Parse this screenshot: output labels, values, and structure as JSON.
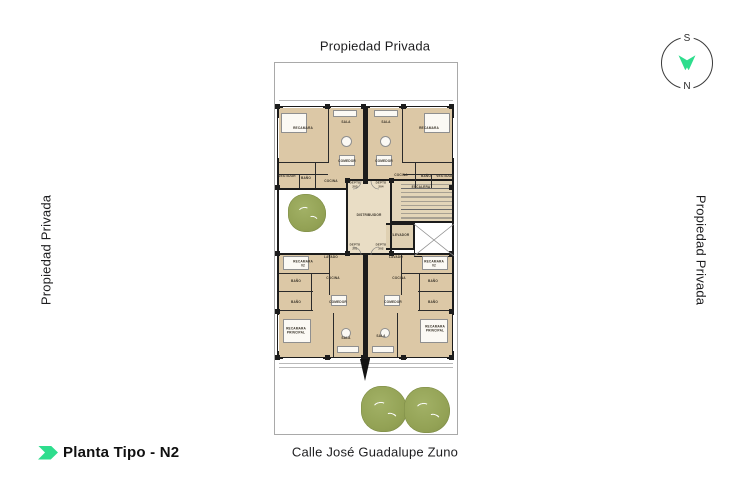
{
  "labels": {
    "top": "Propiedad Privada",
    "left": "Propiedad Privada",
    "right": "Propiedad Privada",
    "street": "Calle José Guadalupe Zuno",
    "title": "Planta Tipo - N2"
  },
  "compass": {
    "top": "S",
    "bottom": "N"
  },
  "colors": {
    "accent": "#2edd8d",
    "floor": "#dcc8a6",
    "floor_light": "#e9ddc5",
    "floor_stairs": "#e3d5b8",
    "floor_elevator": "#dfd0b2",
    "wall": "#1c1c1c",
    "partition": "#2a2a2a",
    "tree": "#93a255",
    "ledge": "#b9b9b9"
  },
  "plan": {
    "areas": [
      {
        "n": "ul-apartment",
        "x": 4,
        "y": 45,
        "w": 85,
        "h": 80,
        "c": "#dcc8a6"
      },
      {
        "n": "ur-apartment",
        "x": 93,
        "y": 45,
        "w": 84,
        "h": 71,
        "c": "#dcc8a6"
      },
      {
        "n": "ll-apartment",
        "x": 4,
        "y": 192,
        "w": 85,
        "h": 102,
        "c": "#dcc8a6"
      },
      {
        "n": "lr-apartment",
        "x": 93,
        "y": 192,
        "w": 84,
        "h": 102,
        "c": "#dcc8a6"
      },
      {
        "n": "distribuidor-area",
        "x": 73,
        "y": 118,
        "w": 43,
        "h": 72,
        "c": "#e9ddc5"
      },
      {
        "n": "escalera-area",
        "x": 117,
        "y": 118,
        "w": 60,
        "h": 42,
        "c": "#e3d5b8"
      },
      {
        "n": "elevador-area",
        "x": 111,
        "y": 161,
        "w": 27,
        "h": 25,
        "c": "#dfd0b2"
      }
    ],
    "walls": [
      {
        "x": 2,
        "y": 43,
        "w": 177,
        "h": 2
      },
      {
        "x": 2,
        "y": 294,
        "w": 177,
        "h": 2
      },
      {
        "x": 2,
        "y": 43,
        "w": 2,
        "h": 253
      },
      {
        "x": 177,
        "y": 43,
        "w": 2,
        "h": 253
      },
      {
        "x": 88,
        "y": 43,
        "w": 5,
        "h": 78
      },
      {
        "x": 88,
        "y": 190,
        "w": 5,
        "h": 106
      },
      {
        "x": 71,
        "y": 116,
        "w": 108,
        "h": 2
      },
      {
        "x": 2,
        "y": 190,
        "w": 177,
        "h": 2
      },
      {
        "x": 71,
        "y": 116,
        "w": 2,
        "h": 76
      },
      {
        "x": 115,
        "y": 116,
        "w": 2,
        "h": 76
      },
      {
        "x": 2,
        "y": 125,
        "w": 71,
        "h": 2
      },
      {
        "x": 117,
        "y": 158,
        "w": 62,
        "h": 1.5
      },
      {
        "x": 111,
        "y": 160,
        "w": 28,
        "h": 1.5
      },
      {
        "x": 111,
        "y": 185,
        "w": 28,
        "h": 1.5
      },
      {
        "x": 138,
        "y": 160,
        "w": 1.5,
        "h": 26
      },
      {
        "x": 139,
        "y": 160,
        "w": 1,
        "h": 34
      },
      {
        "x": 139,
        "y": 193,
        "w": 40,
        "h": 1
      },
      {
        "x": 53,
        "y": 45,
        "w": 1,
        "h": 55,
        "c": "#2a2a2a"
      },
      {
        "x": 4,
        "y": 99,
        "w": 49,
        "h": 1,
        "c": "#2a2a2a"
      },
      {
        "x": 4,
        "y": 111,
        "w": 49,
        "h": 1,
        "c": "#2a2a2a"
      },
      {
        "x": 24,
        "y": 111,
        "w": 1,
        "h": 14,
        "c": "#2a2a2a"
      },
      {
        "x": 40,
        "y": 99,
        "w": 1,
        "h": 26,
        "c": "#2a2a2a"
      },
      {
        "x": 127,
        "y": 45,
        "w": 1,
        "h": 55,
        "c": "#2a2a2a"
      },
      {
        "x": 128,
        "y": 99,
        "w": 49,
        "h": 1,
        "c": "#2a2a2a"
      },
      {
        "x": 128,
        "y": 111,
        "w": 49,
        "h": 1,
        "c": "#2a2a2a"
      },
      {
        "x": 156,
        "y": 111,
        "w": 1,
        "h": 14,
        "c": "#2a2a2a"
      },
      {
        "x": 140,
        "y": 99,
        "w": 1,
        "h": 26,
        "c": "#2a2a2a"
      },
      {
        "x": 4,
        "y": 210,
        "w": 50,
        "h": 1,
        "c": "#2a2a2a"
      },
      {
        "x": 54,
        "y": 192,
        "w": 1,
        "h": 40,
        "c": "#2a2a2a"
      },
      {
        "x": 4,
        "y": 228,
        "w": 34,
        "h": 1,
        "c": "#2a2a2a"
      },
      {
        "x": 4,
        "y": 247,
        "w": 34,
        "h": 1,
        "c": "#2a2a2a"
      },
      {
        "x": 36,
        "y": 210,
        "w": 1,
        "h": 38,
        "c": "#2a2a2a"
      },
      {
        "x": 58,
        "y": 250,
        "w": 1,
        "h": 44,
        "c": "#2a2a2a"
      },
      {
        "x": 127,
        "y": 210,
        "w": 50,
        "h": 1,
        "c": "#2a2a2a"
      },
      {
        "x": 126,
        "y": 192,
        "w": 1,
        "h": 40,
        "c": "#2a2a2a"
      },
      {
        "x": 143,
        "y": 228,
        "w": 34,
        "h": 1,
        "c": "#2a2a2a"
      },
      {
        "x": 143,
        "y": 247,
        "w": 34,
        "h": 1,
        "c": "#2a2a2a"
      },
      {
        "x": 144,
        "y": 210,
        "w": 1,
        "h": 38,
        "c": "#2a2a2a"
      },
      {
        "x": 122,
        "y": 250,
        "w": 1,
        "h": 44,
        "c": "#2a2a2a"
      },
      {
        "x": 4,
        "y": 37,
        "w": 174,
        "h": 0.8,
        "c": "#b9b9b9"
      },
      {
        "x": 4,
        "y": 300,
        "w": 174,
        "h": 0.8,
        "c": "#b9b9b9"
      },
      {
        "x": 4,
        "y": 304,
        "w": 174,
        "h": 0.8,
        "c": "#b9b9b9"
      },
      {
        "x": 8,
        "y": 44,
        "w": 40,
        "h": 1,
        "c": "#ffffff"
      },
      {
        "x": 56,
        "y": 44,
        "w": 30,
        "h": 1,
        "c": "#ffffff"
      },
      {
        "x": 95,
        "y": 44,
        "w": 29,
        "h": 1,
        "c": "#ffffff"
      },
      {
        "x": 132,
        "y": 44,
        "w": 40,
        "h": 1,
        "c": "#ffffff"
      },
      {
        "x": 8,
        "y": 295,
        "w": 40,
        "h": 1,
        "c": "#ffffff"
      },
      {
        "x": 56,
        "y": 295,
        "w": 30,
        "h": 1,
        "c": "#ffffff"
      },
      {
        "x": 95,
        "y": 295,
        "w": 29,
        "h": 1,
        "c": "#ffffff"
      },
      {
        "x": 132,
        "y": 295,
        "w": 40,
        "h": 1,
        "c": "#ffffff"
      },
      {
        "x": 3,
        "y": 55,
        "w": 1,
        "h": 40,
        "c": "#ffffff"
      },
      {
        "x": 178,
        "y": 55,
        "w": 1,
        "h": 40,
        "c": "#ffffff"
      },
      {
        "x": 3,
        "y": 252,
        "w": 1,
        "h": 36,
        "c": "#ffffff"
      },
      {
        "x": 178,
        "y": 252,
        "w": 1,
        "h": 36,
        "c": "#ffffff"
      }
    ],
    "columns": [
      {
        "x": 0,
        "y": 41
      },
      {
        "x": 50,
        "y": 41
      },
      {
        "x": 86,
        "y": 41
      },
      {
        "x": 126,
        "y": 41
      },
      {
        "x": 174,
        "y": 41
      },
      {
        "x": 0,
        "y": 292
      },
      {
        "x": 50,
        "y": 292
      },
      {
        "x": 86,
        "y": 292
      },
      {
        "x": 126,
        "y": 292
      },
      {
        "x": 174,
        "y": 292
      },
      {
        "x": 0,
        "y": 122
      },
      {
        "x": 0,
        "y": 188
      },
      {
        "x": 0,
        "y": 246
      },
      {
        "x": 174,
        "y": 122
      },
      {
        "x": 174,
        "y": 188
      },
      {
        "x": 174,
        "y": 246
      },
      {
        "x": 70,
        "y": 115
      },
      {
        "x": 114,
        "y": 115
      },
      {
        "x": 70,
        "y": 188
      },
      {
        "x": 114,
        "y": 188
      }
    ],
    "rooms": [
      {
        "t": "RECAMARA",
        "x": 28,
        "y": 66
      },
      {
        "t": "SALA",
        "x": 71,
        "y": 60
      },
      {
        "t": "COMEDOR",
        "x": 72,
        "y": 99
      },
      {
        "t": "VESTIDOR",
        "x": 12,
        "y": 114
      },
      {
        "t": "BAÑO",
        "x": 31,
        "y": 116
      },
      {
        "t": "COCINA",
        "x": 56,
        "y": 119
      },
      {
        "t": "SALA",
        "x": 111,
        "y": 60
      },
      {
        "t": "RECAMARA",
        "x": 154,
        "y": 66
      },
      {
        "t": "COMEDOR",
        "x": 109,
        "y": 99
      },
      {
        "t": "COCINA",
        "x": 126,
        "y": 113
      },
      {
        "t": "BAÑO",
        "x": 151,
        "y": 114
      },
      {
        "t": "VESTIDOR",
        "x": 170,
        "y": 114
      },
      {
        "t": "DEPTO\n203",
        "x": 80,
        "y": 122,
        "cls": "depto"
      },
      {
        "t": "DEPTO\n204",
        "x": 106,
        "y": 122,
        "cls": "depto"
      },
      {
        "t": "ESCALERA",
        "x": 146,
        "y": 125
      },
      {
        "t": "DISTRIBUIDOR",
        "x": 94,
        "y": 153
      },
      {
        "t": "ELEVADOR",
        "x": 125,
        "y": 173
      },
      {
        "t": "DEPTO\n201",
        "x": 80,
        "y": 184,
        "cls": "depto"
      },
      {
        "t": "DEPTO\n202",
        "x": 106,
        "y": 184,
        "cls": "depto"
      },
      {
        "t": "LAVADO",
        "x": 56,
        "y": 195
      },
      {
        "t": "RECAMARA 02",
        "x": 28,
        "y": 201
      },
      {
        "t": "COCINA",
        "x": 58,
        "y": 216
      },
      {
        "t": "BAÑO",
        "x": 21,
        "y": 219
      },
      {
        "t": "BAÑO",
        "x": 21,
        "y": 240
      },
      {
        "t": "COMEDOR",
        "x": 63,
        "y": 240
      },
      {
        "t": "RECAMARA\nPRINCIPAL",
        "x": 21,
        "y": 268
      },
      {
        "t": "SALA",
        "x": 71,
        "y": 276
      },
      {
        "t": "LAVADO",
        "x": 121,
        "y": 195
      },
      {
        "t": "RECAMARA 02",
        "x": 159,
        "y": 201
      },
      {
        "t": "COCINA",
        "x": 124,
        "y": 216
      },
      {
        "t": "BAÑO",
        "x": 158,
        "y": 219
      },
      {
        "t": "BAÑO",
        "x": 158,
        "y": 240
      },
      {
        "t": "COMEDOR",
        "x": 118,
        "y": 240
      },
      {
        "t": "SALA",
        "x": 106,
        "y": 274
      },
      {
        "t": "RECAMARA\nPRINCIPAL",
        "x": 160,
        "y": 266
      }
    ],
    "stairs": {
      "x": 126,
      "y": 121,
      "w": 51,
      "h": 36
    },
    "trees": [
      {
        "n": "patio-tree",
        "cx": 32,
        "cy": 150,
        "r": 19
      },
      {
        "n": "street-tree",
        "cx": 109,
        "cy": 346,
        "r": 23
      },
      {
        "n": "street-tree",
        "cx": 152,
        "cy": 347,
        "r": 23
      }
    ],
    "entry": {
      "x": 85,
      "y": 296
    },
    "furniture": [
      {
        "s": "rect",
        "x": 6,
        "y": 50,
        "w": 26,
        "h": 20
      },
      {
        "s": "rect",
        "x": 149,
        "y": 50,
        "w": 26,
        "h": 20
      },
      {
        "s": "rect",
        "x": 58,
        "y": 47,
        "w": 24,
        "h": 7
      },
      {
        "s": "rect",
        "x": 99,
        "y": 47,
        "w": 24,
        "h": 7
      },
      {
        "s": "circle",
        "x": 66,
        "y": 73,
        "w": 11,
        "h": 11
      },
      {
        "s": "circle",
        "x": 105,
        "y": 73,
        "w": 11,
        "h": 11
      },
      {
        "s": "rect",
        "x": 64,
        "y": 92,
        "w": 16,
        "h": 11
      },
      {
        "s": "rect",
        "x": 101,
        "y": 92,
        "w": 16,
        "h": 11
      },
      {
        "s": "rect",
        "x": 8,
        "y": 193,
        "w": 26,
        "h": 14
      },
      {
        "s": "rect",
        "x": 147,
        "y": 193,
        "w": 26,
        "h": 14
      },
      {
        "s": "rect",
        "x": 8,
        "y": 256,
        "w": 28,
        "h": 24
      },
      {
        "s": "rect",
        "x": 145,
        "y": 256,
        "w": 28,
        "h": 24
      },
      {
        "s": "rect",
        "x": 56,
        "y": 232,
        "w": 16,
        "h": 11
      },
      {
        "s": "rect",
        "x": 109,
        "y": 232,
        "w": 16,
        "h": 11
      },
      {
        "s": "circle",
        "x": 66,
        "y": 265,
        "w": 10,
        "h": 10
      },
      {
        "s": "circle",
        "x": 105,
        "y": 265,
        "w": 10,
        "h": 10
      },
      {
        "s": "rect",
        "x": 62,
        "y": 283,
        "w": 22,
        "h": 7
      },
      {
        "s": "rect",
        "x": 97,
        "y": 283,
        "w": 22,
        "h": 7
      }
    ],
    "svg_paths": [
      {
        "d": "M139 161 L179 193 M179 161 L139 193",
        "c": "#909090",
        "w": 0.8
      },
      {
        "d": "M78 126 A8 8 0 0 0 86 118",
        "c": "#777777",
        "w": 0.6
      },
      {
        "d": "M104 126 A8 8 0 0 1 96 118",
        "c": "#777777",
        "w": 0.6
      },
      {
        "d": "M78 184 A8 8 0 0 1 86 192",
        "c": "#777777",
        "w": 0.6
      },
      {
        "d": "M104 184 A8 8 0 0 0 96 192",
        "c": "#777777",
        "w": 0.6
      }
    ]
  }
}
